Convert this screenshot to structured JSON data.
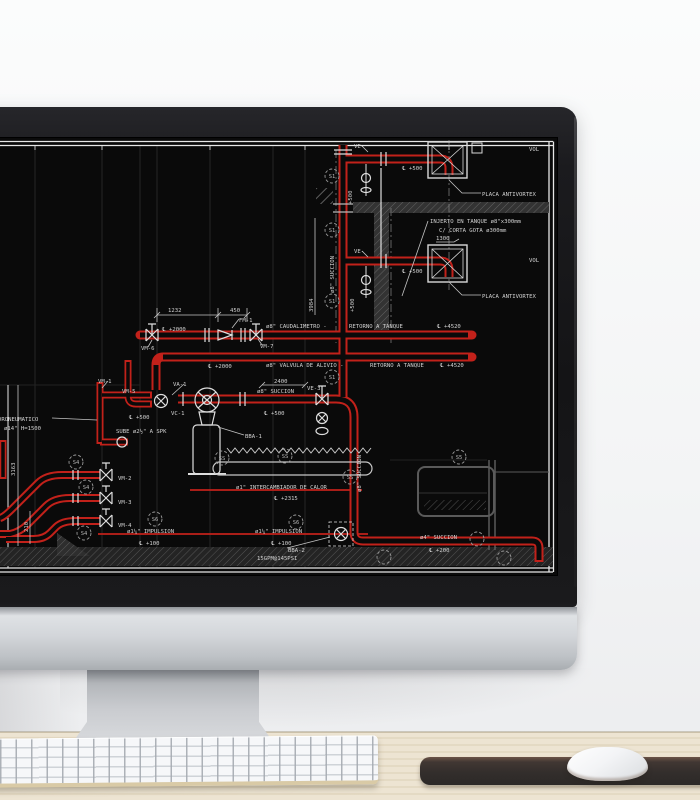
{
  "colors": {
    "screen_bg": "#0a0a0a",
    "pipe_red": "#c2211a",
    "pipe_red_bright": "#e03126",
    "cad_white": "#dcdcdc",
    "cad_text": "#d2d2d2",
    "cad_dim": "#c4c4c4",
    "grid_gray": "#262626",
    "hatch_gray": "#3a3a3a",
    "hatch_line": "#7a7a7a",
    "bubble_gray": "#9a9a9a",
    "bezel_black": "#17171a",
    "chin_silver": "#cfd2d6",
    "desk_tan": "#eae0cb",
    "pad_dark": "#332e2c",
    "keyboard_white": "#f4f5f7",
    "mouse_white": "#f6f7f8"
  },
  "screen": {
    "labels": [
      {
        "t": "VE-",
        "x": 354,
        "y": 10
      },
      {
        "t": "℄ +500",
        "x": 402,
        "y": 32
      },
      {
        "t": "VOL",
        "x": 529,
        "y": 13
      },
      {
        "t": "PLACA ANTIVORTEX",
        "x": 482,
        "y": 58
      },
      {
        "t": "INJERTO EN TANQUE  ø8\"x300mm",
        "x": 430,
        "y": 85
      },
      {
        "t": "C/  CORTA  GOTA  ø300mm",
        "x": 439,
        "y": 94
      },
      {
        "t": "1300",
        "x": 436,
        "y": 102
      },
      {
        "t": "VE-",
        "x": 354,
        "y": 115
      },
      {
        "t": "℄ +500",
        "x": 402,
        "y": 135
      },
      {
        "t": "VOL",
        "x": 529,
        "y": 124
      },
      {
        "t": "PLACA ANTIVORTEX",
        "x": 482,
        "y": 160
      },
      {
        "t": "ø8\" SUCCION",
        "x": 334,
        "y": 155,
        "r": -90
      },
      {
        "t": "+500",
        "x": 352,
        "y": 66,
        "r": -90
      },
      {
        "t": "+500",
        "x": 354,
        "y": 174,
        "r": -90
      },
      {
        "t": "1232",
        "x": 168,
        "y": 174
      },
      {
        "t": "450",
        "x": 230,
        "y": 174
      },
      {
        "t": "FM-1",
        "x": 239,
        "y": 184
      },
      {
        "t": "℄ +2000",
        "x": 162,
        "y": 193
      },
      {
        "t": "ø8\" CAUDALIMETRO -",
        "x": 266,
        "y": 190
      },
      {
        "t": "RETORNO A TANQUE",
        "x": 349,
        "y": 190
      },
      {
        "t": "℄ +4520",
        "x": 437,
        "y": 190
      },
      {
        "t": "3984",
        "x": 313,
        "y": 174,
        "r": -90
      },
      {
        "t": "VM-6",
        "x": 141,
        "y": 212
      },
      {
        "t": "VM-7",
        "x": 260,
        "y": 210
      },
      {
        "t": "℄ +2000",
        "x": 208,
        "y": 230
      },
      {
        "t": "ø8\" VALVULA DE ALIVIO -",
        "x": 266,
        "y": 229
      },
      {
        "t": "RETORNO  A  TANQUE",
        "x": 370,
        "y": 229
      },
      {
        "t": "℄ +4520",
        "x": 440,
        "y": 229
      },
      {
        "t": "VA-1",
        "x": 173,
        "y": 248
      },
      {
        "t": "2400",
        "x": 274,
        "y": 245
      },
      {
        "t": "ø8\" SUCCION",
        "x": 257,
        "y": 255
      },
      {
        "t": "VE-3",
        "x": 307,
        "y": 252
      },
      {
        "t": "VM-5",
        "x": 122,
        "y": 255
      },
      {
        "t": "VM-1",
        "x": 98,
        "y": 245
      },
      {
        "t": "℄ +500",
        "x": 129,
        "y": 281
      },
      {
        "t": "VC-1",
        "x": 171,
        "y": 277
      },
      {
        "t": "℄ +500",
        "x": 264,
        "y": 277
      },
      {
        "t": "DRONEUMATICO",
        "x": -2,
        "y": 283
      },
      {
        "t": "ø14\"  H=1500",
        "x": 4,
        "y": 292
      },
      {
        "t": "SUBE ø2½\" A SPK",
        "x": 116,
        "y": 295
      },
      {
        "t": "BBA-1",
        "x": 245,
        "y": 300
      },
      {
        "t": "ø1\" INTERCAMBIADOR DE CALOR",
        "x": 236,
        "y": 351
      },
      {
        "t": "℄ +2315",
        "x": 274,
        "y": 362
      },
      {
        "t": "ø8\" SUCCION",
        "x": 361,
        "y": 354,
        "r": -90
      },
      {
        "t": "VM-2",
        "x": 118,
        "y": 342
      },
      {
        "t": "VM-3",
        "x": 118,
        "y": 366
      },
      {
        "t": "VM-4",
        "x": 118,
        "y": 389
      },
      {
        "t": "ø1¼\" IMPULSION",
        "x": 127,
        "y": 395
      },
      {
        "t": "℄ +100",
        "x": 139,
        "y": 407
      },
      {
        "t": "ø1¼\" IMPULSION",
        "x": 255,
        "y": 395
      },
      {
        "t": "℄ +100",
        "x": 271,
        "y": 407
      },
      {
        "t": "BBA-2",
        "x": 288,
        "y": 414
      },
      {
        "t": "15GPM@145PSI",
        "x": 257,
        "y": 422
      },
      {
        "t": "ø4\" SUCCION",
        "x": 420,
        "y": 401
      },
      {
        "t": "℄ +200",
        "x": 429,
        "y": 414
      },
      {
        "t": "3163",
        "x": 15,
        "y": 338,
        "r": -90
      },
      {
        "t": "210",
        "x": 28,
        "y": 394,
        "r": -90
      }
    ],
    "bubbles": [
      {
        "t": "S1",
        "x": 332,
        "y": 38
      },
      {
        "t": "S1",
        "x": 332,
        "y": 92
      },
      {
        "t": "S1",
        "x": 332,
        "y": 163
      },
      {
        "t": "S1",
        "x": 332,
        "y": 239
      },
      {
        "t": "S4",
        "x": 76,
        "y": 324
      },
      {
        "t": "S4",
        "x": 86,
        "y": 349
      },
      {
        "t": "S4",
        "x": 84,
        "y": 395
      },
      {
        "t": "S5",
        "x": 459,
        "y": 319
      },
      {
        "t": "S6",
        "x": 155,
        "y": 381
      },
      {
        "t": "S6",
        "x": 296,
        "y": 384
      },
      {
        "t": "SS",
        "x": 222,
        "y": 320
      },
      {
        "t": "SS",
        "x": 285,
        "y": 318
      },
      {
        "t": "SS",
        "x": 350,
        "y": 339
      },
      {
        "t": "",
        "x": 477,
        "y": 401
      },
      {
        "t": "",
        "x": 384,
        "y": 419
      },
      {
        "t": "",
        "x": 504,
        "y": 420
      }
    ]
  }
}
